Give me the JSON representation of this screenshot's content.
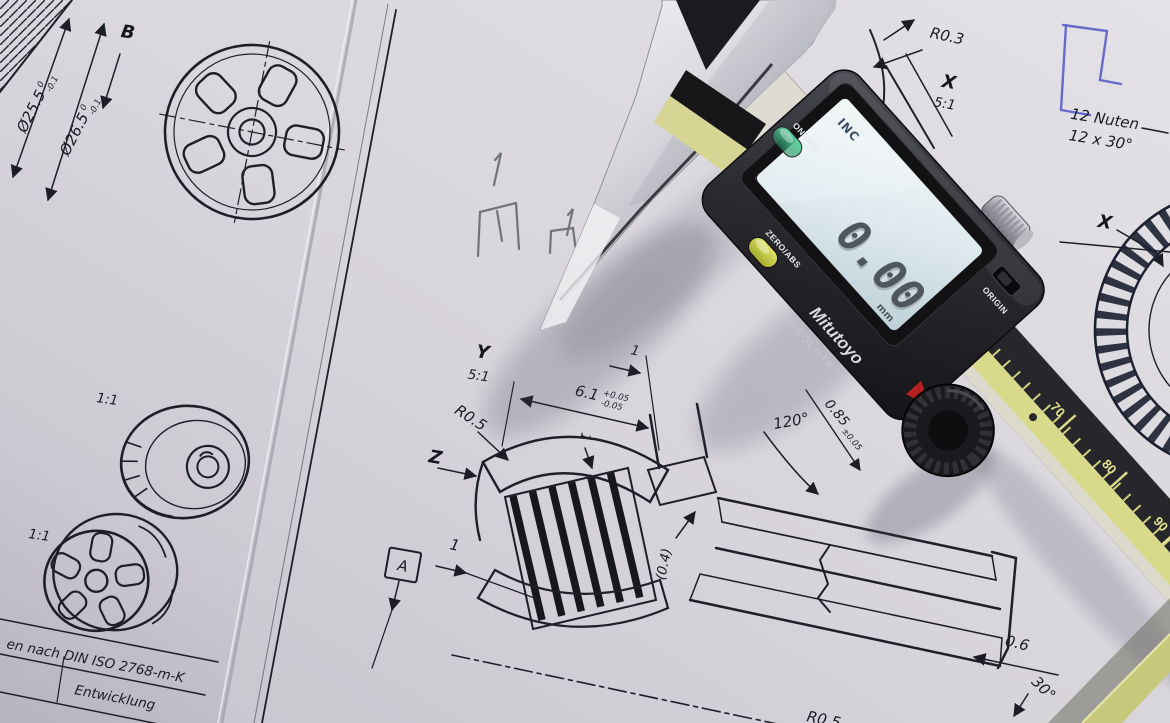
{
  "left_sheet": {
    "dim_inner": {
      "value": "Ø25.5",
      "tol_upper": "0",
      "tol_lower": "-0.1"
    },
    "dim_outer": {
      "value": "Ø26.5",
      "tol_upper": "0",
      "tol_lower": "-0.1"
    },
    "view_label": "B",
    "scale_top": "1:1",
    "scale_bottom": "1:1",
    "title_block": {
      "norm_row": "en nach DIN ISO 2768-m-K",
      "cell": "Entwicklung"
    }
  },
  "right_sheet": {
    "radius_top": "R0.3",
    "detail_x_top": {
      "label": "X",
      "scale": "5:1"
    },
    "nuten_note": {
      "line1": "12 Nuten",
      "line2": "12 x 30°"
    },
    "detail_x_right": "X",
    "detail_y": {
      "label": "Y",
      "scale": "5:1"
    },
    "radius_mid": "R0.5",
    "detail_z": "Z",
    "dim_width": {
      "value": "6.1",
      "tol_upper": "+0.05",
      "tol_lower": "-0.05"
    },
    "dim_one_top": "1",
    "dim_one_groove": "1",
    "angle_120": "120°",
    "dim_chamfer": {
      "value": "0.85",
      "tol": "±0.05"
    },
    "datum_label": "A",
    "dim_one_left": "1",
    "dim_paren": "(0.4)",
    "dim_edge": "0.6",
    "angle_30": "30°",
    "radius_bottom_partial": "R0.5"
  },
  "caliper": {
    "display": {
      "mode": "INC",
      "value": "0.00",
      "unit": "mm"
    },
    "buttons": {
      "origin": "ORIGIN",
      "power": "ON/OFF",
      "zero": "ZERO/ABS"
    },
    "brand": {
      "name": "Mitutoyo",
      "series": "ABSOLUTE"
    },
    "scale_zero": "0",
    "scale_numbers": [
      "70",
      "80",
      "90"
    ],
    "colors": {
      "body": "#232327",
      "scale_stripe": "#d8d98a",
      "power_button": "#3fbf8f",
      "zero_button": "#cfd64a",
      "logo": "#b51f1f"
    }
  },
  "annotations": {
    "pen_color": "#5a5dc8",
    "pencil_color": "#73737d"
  }
}
